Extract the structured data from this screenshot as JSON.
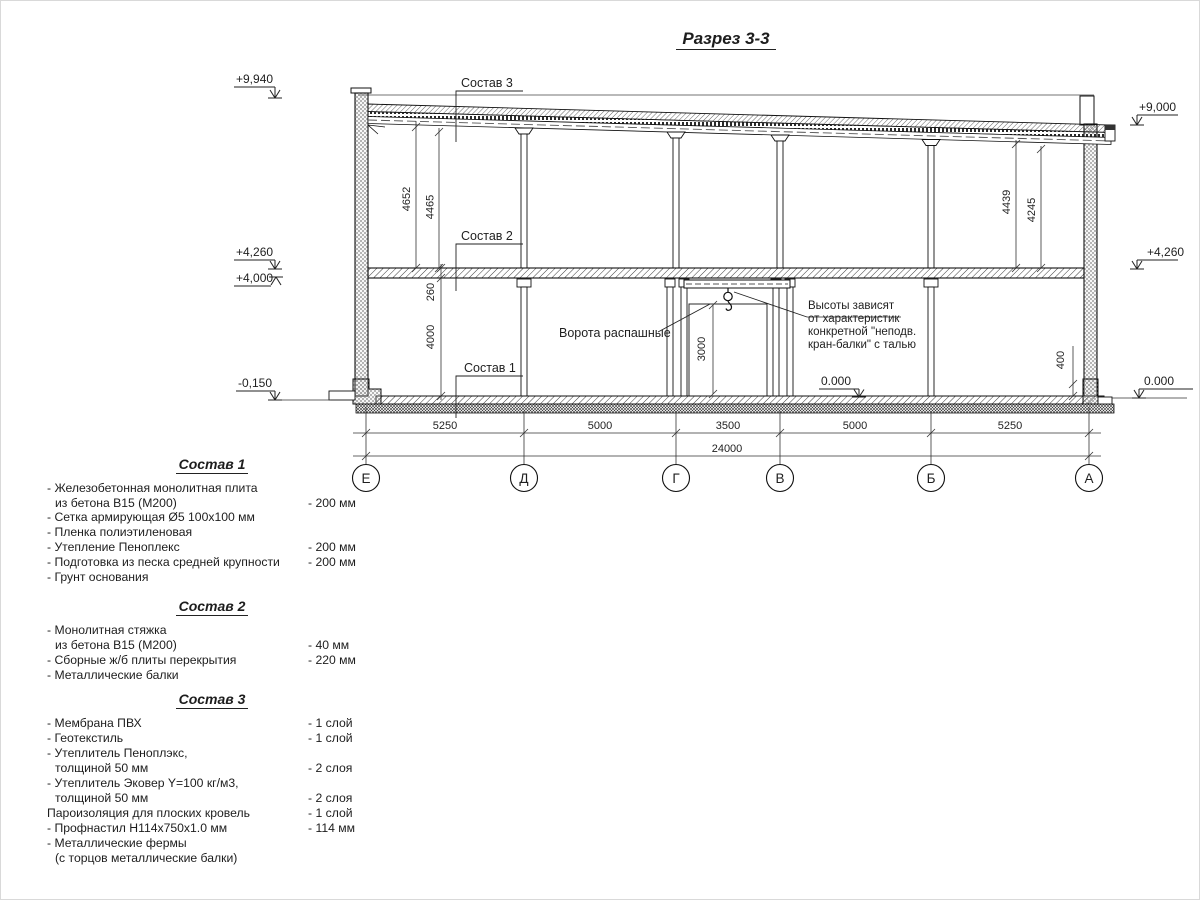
{
  "title": "Разрез 3-3",
  "drawing": {
    "elevations": {
      "p9940": "+9,940",
      "p9000": "+9,000",
      "p4260l": "+4,260",
      "p4000": "+4,000",
      "p4260r": "+4,260",
      "m0150": "-0,150",
      "zero_inner": "0.000",
      "zero_right": "0.000"
    },
    "dims": {
      "d4652": "4652",
      "d4465": "4465",
      "d4439": "4439",
      "d4245": "4245",
      "d260": "260",
      "d4000": "4000",
      "d3000": "3000",
      "d400": "400"
    },
    "bottom_dims": [
      "5250",
      "5000",
      "3500",
      "5000",
      "5250"
    ],
    "total_dim": "24000",
    "axes": [
      "Е",
      "Д",
      "Г",
      "В",
      "Б",
      "А"
    ],
    "leaders": {
      "sostav1": "Состав 1",
      "sostav2": "Состав 2",
      "sostav3": "Состав 3",
      "gate": "Ворота распашные",
      "crane_note": [
        "Высоты зависят",
        "от характеристик",
        "конкретной \"неподв.",
        "кран-балки\" с талью"
      ]
    }
  },
  "compositions": [
    {
      "heading": "Состав 1",
      "rows": [
        {
          "text": "- Железобетонная  монолитная плита",
          "value": ""
        },
        {
          "text": "из бетона  В15 (М200)",
          "value": "- 200 мм"
        },
        {
          "text": "- Сетка армирующая Ø5 100х100 мм",
          "value": ""
        },
        {
          "text": "- Пленка полиэтиленовая",
          "value": ""
        },
        {
          "text": "- Утепление Пеноплекс",
          "value": "- 200 мм"
        },
        {
          "text": "- Подготовка из песка средней  крупности",
          "value": "- 200 мм"
        },
        {
          "text": "- Грунт основания",
          "value": ""
        }
      ]
    },
    {
      "heading": "Состав 2",
      "rows": [
        {
          "text": "- Монолитная стяжка",
          "value": ""
        },
        {
          "text": "из бетона В15 (М200)",
          "value": "- 40 мм"
        },
        {
          "text": "- Сборные ж/б плиты перекрытия",
          "value": "- 220 мм"
        },
        {
          "text": "- Металлические балки",
          "value": ""
        }
      ]
    },
    {
      "heading": "Состав 3",
      "rows": [
        {
          "text": "- Мембрана ПВХ",
          "value": "- 1 слой"
        },
        {
          "text": "- Геотекстиль",
          "value": "- 1 слой"
        },
        {
          "text": "- Утеплитель Пеноплэкс,",
          "value": ""
        },
        {
          "text": "толщиной 50 мм",
          "value": "- 2 слоя"
        },
        {
          "text": "- Утеплитель Эковер Y=100 кг/м3,",
          "value": ""
        },
        {
          "text": "толщиной 50 мм",
          "value": "- 2 слоя"
        },
        {
          "text": "Пароизоляция для плоских кровель",
          "value": "- 1 слой"
        },
        {
          "text": "- Профнастил Н114х750х1.0 мм",
          "value": "- 114 мм"
        },
        {
          "text": "- Металлические фермы",
          "value": ""
        },
        {
          "text": "(с торцов металлические балки)",
          "value": ""
        }
      ]
    }
  ]
}
